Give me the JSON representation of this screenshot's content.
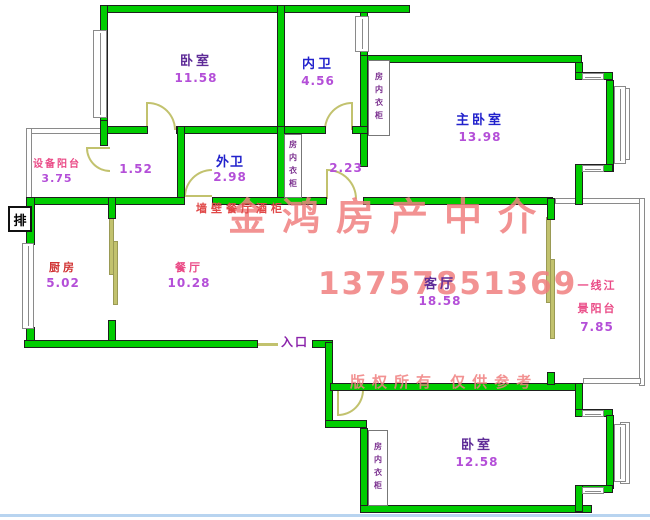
{
  "colors": {
    "wall": "#00cc00",
    "wall-border": "#1f1f1f",
    "door": "#c2c26e",
    "window-border": "#8a8a8a",
    "balcony-border": "#8a8a8a",
    "watermark": "#f08080",
    "watermark-small": "#e04848",
    "blue": "#2222cc",
    "purple": "#5e2b97",
    "red": "#d03333",
    "pink": "#ea4a86",
    "violet": "#b44fd8",
    "entry": "#8a22aa",
    "closet-text": "#7a2e8e"
  },
  "rooms": [
    {
      "name": "bedroom-top",
      "label": "卧室",
      "area": "11.58"
    },
    {
      "name": "inner-bath",
      "label": "内卫",
      "area": "4.56"
    },
    {
      "name": "master-bedroom",
      "label": "主卧室",
      "area": "13.98"
    },
    {
      "name": "equipment-balcony",
      "label": "设备阳台",
      "area": "3.75"
    },
    {
      "name": "hallway-1",
      "label": "",
      "area": "1.52"
    },
    {
      "name": "outer-bath",
      "label": "外卫",
      "area": "2.98"
    },
    {
      "name": "hallway-2",
      "label": "",
      "area": "2.23"
    },
    {
      "name": "kitchen",
      "label": "厨房",
      "area": "5.02"
    },
    {
      "name": "dining-room",
      "label": "餐厅",
      "area": "10.28"
    },
    {
      "name": "living-room",
      "label": "客厅",
      "area": "18.58"
    },
    {
      "name": "river-view-balcony",
      "label_line1": "一线江",
      "label_line2": "景阳台",
      "area": "7.85"
    },
    {
      "name": "bedroom-bottom",
      "label": "卧室",
      "area": "12.58"
    }
  ],
  "annotations": {
    "entrance": "入口",
    "drain": "排",
    "closet": "房内衣柜"
  },
  "watermarks": {
    "brand": "金鸿房产中介",
    "phone": "13757851369",
    "cabinet_note": "墙壁餐厅酒柜",
    "copyright": "版权所有 仅供参考"
  }
}
